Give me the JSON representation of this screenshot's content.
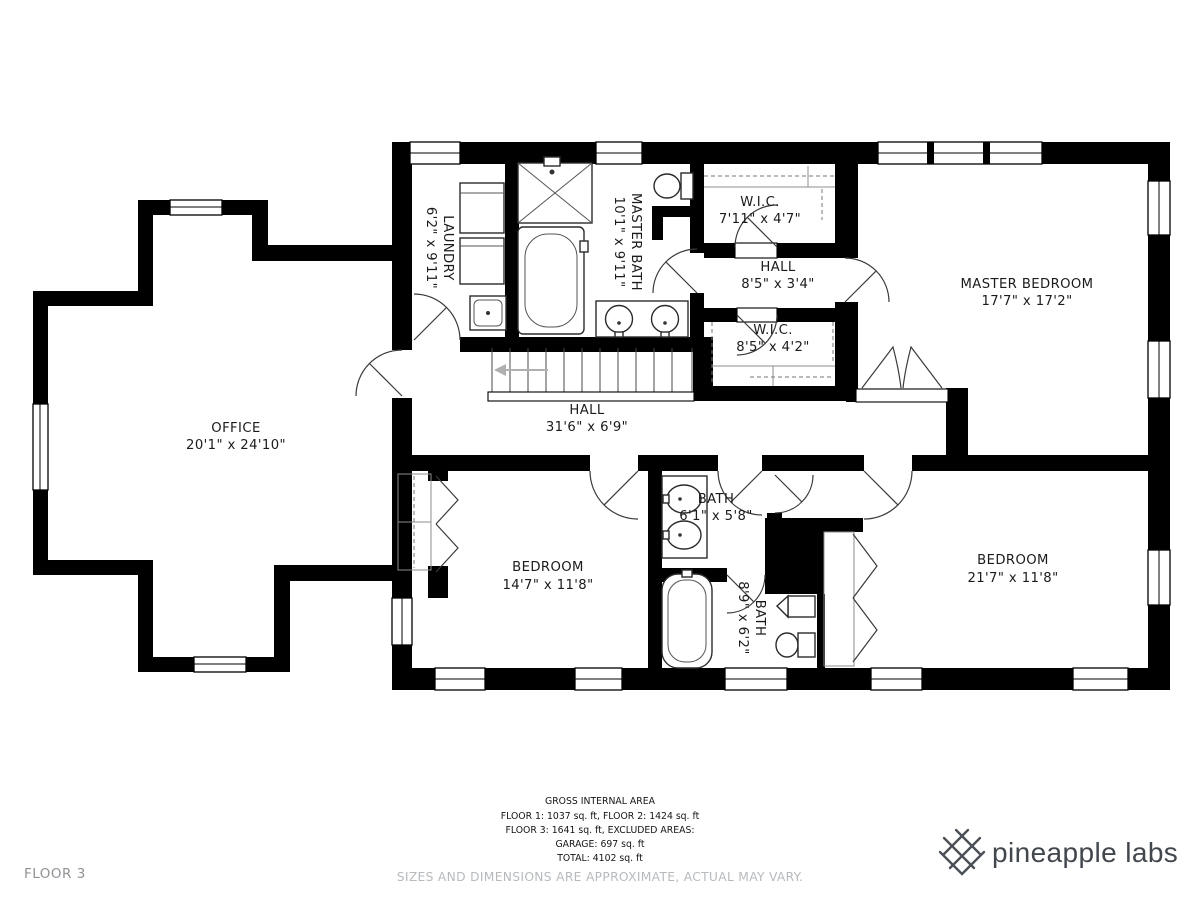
{
  "floor_label": "FLOOR 3",
  "rooms": {
    "office": {
      "name": "OFFICE",
      "dims": "20'1\" x 24'10\""
    },
    "laundry": {
      "name": "LAUNDRY",
      "dims": "6'2\" x 9'11\""
    },
    "master_bath": {
      "name": "MASTER BATH",
      "dims": "10'1\" x 9'11\""
    },
    "wic_top": {
      "name": "W.I.C.",
      "dims": "7'11\" x 4'7\""
    },
    "hall_small": {
      "name": "HALL",
      "dims": "8'5\" x 3'4\""
    },
    "wic_bottom": {
      "name": "W.I.C.",
      "dims": "8'5\" x 4'2\""
    },
    "master_bedroom": {
      "name": "MASTER BEDROOM",
      "dims": "17'7\" x 17'2\""
    },
    "hall_main": {
      "name": "HALL",
      "dims": "31'6\" x 6'9\""
    },
    "bedroom_left": {
      "name": "BEDROOM",
      "dims": "14'7\" x 11'8\""
    },
    "bath_upper": {
      "name": "BATH",
      "dims": "6'1\" x 5'8\""
    },
    "bath_lower": {
      "name": "BATH",
      "dims": "8'9\" x 6'2\""
    },
    "bedroom_right": {
      "name": "BEDROOM",
      "dims": "21'7\" x 11'8\""
    }
  },
  "footer": {
    "area_title": "GROSS INTERNAL AREA",
    "area_lines": [
      "FLOOR 1: 1037 sq. ft, FLOOR 2: 1424 sq. ft",
      "FLOOR 3: 1641 sq. ft, EXCLUDED AREAS:",
      "GARAGE: 697 sq. ft",
      "TOTAL: 4102 sq. ft"
    ],
    "disclaimer": "SIZES AND DIMENSIONS ARE APPROXIMATE, ACTUAL MAY VARY."
  },
  "brand": {
    "name": "pineapple labs",
    "icon": "pineapple-lattice-icon"
  },
  "colors": {
    "wall": "#000000",
    "text": "#1b1b1b",
    "muted_gray": "#8f9396",
    "light_gray": "#b7babd",
    "brand_gray": "#42474e"
  }
}
